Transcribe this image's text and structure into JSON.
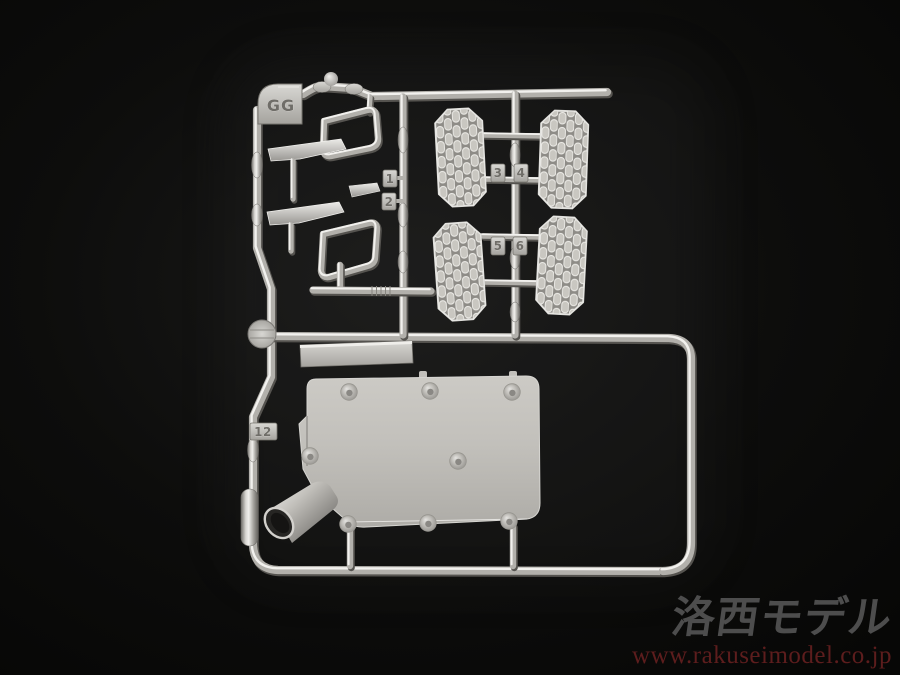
{
  "meta": {
    "subject": "Photograph of a silver-plated plastic model kit runner (sprue) on a black background",
    "width": 900,
    "height": 675
  },
  "photo": {
    "background_color": "#0a0a09",
    "plastic_base_color": "#b2b0ab",
    "plastic_highlight_color": "#f2f1ee",
    "plastic_shadow_color": "#55534f"
  },
  "sprue": {
    "gate_label": "GG",
    "tags": {
      "t1": "1",
      "t2": "2",
      "t3": "3",
      "t4": "4",
      "t5": "5",
      "t6": "6",
      "t12": "12"
    },
    "parts": [
      {
        "name": "runner-frame",
        "description": "rectangular runner frame with zig-zag left rail"
      },
      {
        "name": "side-mirror-housings",
        "count": 2
      },
      {
        "name": "mirror-arm-blades",
        "count": 3
      },
      {
        "name": "tread-step-plates",
        "count": 4,
        "tag_numbers": [
          "3",
          "4",
          "5",
          "6"
        ]
      },
      {
        "name": "mounting-plate",
        "tag_number": "12",
        "rivet_count": 8
      },
      {
        "name": "exhaust-cone",
        "count": 1
      },
      {
        "name": "rectangular-step-bar",
        "count": 1
      },
      {
        "name": "round-gate-disc",
        "count": 1
      }
    ]
  },
  "watermark": {
    "logo_text": "洛西モデル",
    "url_text": "www.rakuseimodel.co.jp",
    "logo_color": "#4d4d4d",
    "url_color": "#5d1d1d"
  }
}
